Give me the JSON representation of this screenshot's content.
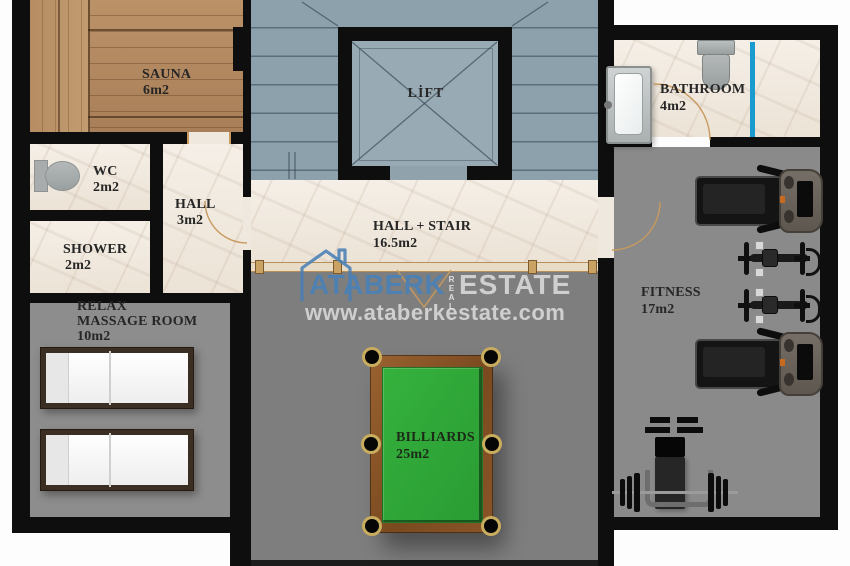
{
  "brand": {
    "primary": "ATABERK",
    "middle": "REAL",
    "secondary": "ESTATE",
    "url": "www.ataberkestate.com"
  },
  "rooms": {
    "sauna": {
      "name": "SAUNA",
      "area": "6m2"
    },
    "wc": {
      "name": "WC",
      "area": "2m2"
    },
    "hall": {
      "name": "HALL",
      "area": "3m2"
    },
    "shower": {
      "name": "SHOWER",
      "area": "2m2"
    },
    "relax": {
      "line1": "RELAX",
      "line2": "MASSAGE ROOM",
      "area": "10m2"
    },
    "lift": {
      "name": "LİFT"
    },
    "hall_stair": {
      "name": "HALL + STAIR",
      "area": "16.5m2"
    },
    "billiards": {
      "name": "BILLIARDS",
      "area": "25m2"
    },
    "bathroom": {
      "name": "BATHROOM",
      "area": "4m2"
    },
    "fitness": {
      "name": "FITNESS",
      "area": "17m2"
    }
  },
  "colors": {
    "wall": "#0e0e0e",
    "stair_floor": "#8da1ac",
    "marble": "#f2ebe2",
    "gray_floor": "#7e7e7e",
    "wood": "#b48b61",
    "felt_green": "#2fa338",
    "glass_blue": "#1a9bd0",
    "brand_blue": "#4a80b5",
    "door_tan": "#c89a5e"
  }
}
